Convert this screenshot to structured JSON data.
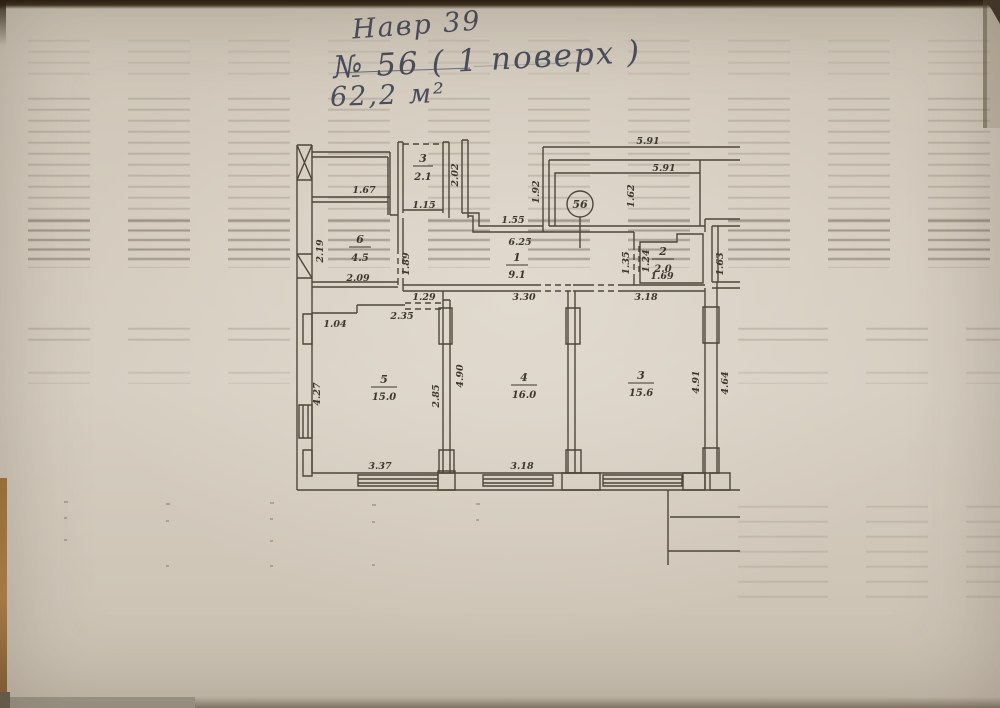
{
  "colors": {
    "paper": "#d2c9bc",
    "ink": "#4d4639",
    "pen": "#4a4e5c"
  },
  "notes": {
    "line1": "Навр 39",
    "line2": "№ 56 ( 1 поверх )",
    "line3": "62,2 м²"
  },
  "plan": {
    "badge": "56",
    "rooms": [
      {
        "number": "3",
        "area": "2.1"
      },
      {
        "number": "6",
        "area": "4.5"
      },
      {
        "number": "1",
        "area": "9.1"
      },
      {
        "number": "2",
        "area": "2.0"
      },
      {
        "number": "5",
        "area": "15.0"
      },
      {
        "number": "4",
        "area": "16.0"
      },
      {
        "number": "3",
        "area": "15.6"
      }
    ],
    "dims": [
      "5.91",
      "5.91",
      "1.62",
      "1.92",
      "2.02",
      "1.15",
      "1.67",
      "1.55",
      "6.25",
      "2.19",
      "1.89",
      "2.09",
      "1.29",
      "2.35",
      "1.04",
      "3.30",
      "3.18",
      "1.35",
      "1.24",
      "1.69",
      "1.63",
      "4.27",
      "2.85",
      "4.90",
      "4.91",
      "4.64",
      "3.37",
      "3.18"
    ]
  }
}
